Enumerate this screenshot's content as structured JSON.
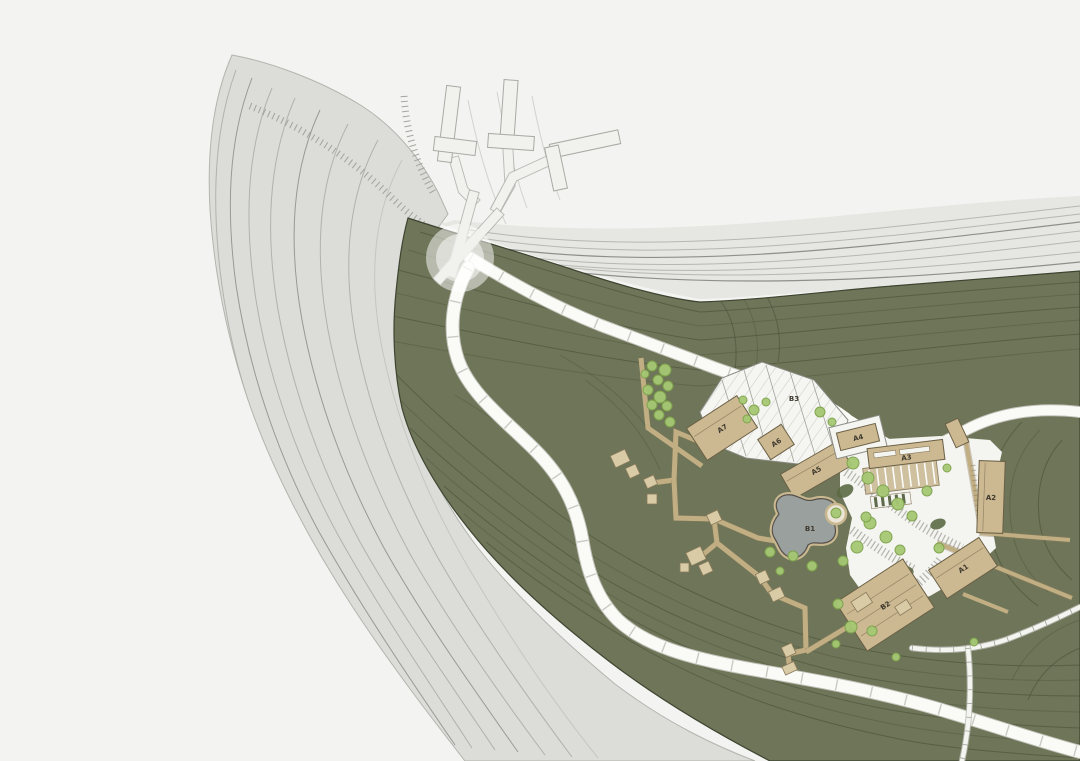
{
  "buildings": [
    {
      "label": "A7"
    },
    {
      "label": "A6"
    },
    {
      "label": "A5"
    },
    {
      "label": "A4"
    },
    {
      "label": "A3"
    },
    {
      "label": "A2"
    },
    {
      "label": "A1"
    },
    {
      "label": "B1"
    },
    {
      "label": "B2"
    },
    {
      "label": "B3"
    }
  ],
  "colors": {
    "background": "#f3f4f1",
    "cliff_gray": "#dcddd8",
    "cliff_contour": "#a9aaa4",
    "hillside_green": "#6e7558",
    "hillside_contour": "#454c35",
    "road_white": "#fafaf7",
    "road_edge": "#cfcfc8",
    "boardwalk_tan": "#c2ae83",
    "building_tan": "#ccb992",
    "building_outline": "#6b6046",
    "white_terrace": "#f5f5f1",
    "tree_green": "#a5c873",
    "pool_gray": "#9aa09e",
    "label_text": "#3e392e"
  }
}
